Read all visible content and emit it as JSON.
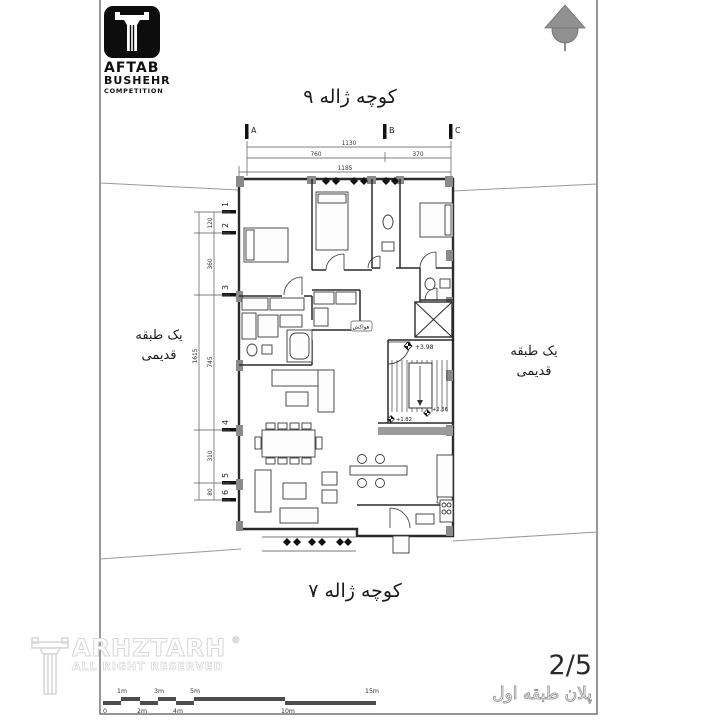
{
  "logo": {
    "title": "AFTAB",
    "subtitle": "BUSHEHR",
    "tagline": "COMPETITION"
  },
  "streets": {
    "top": "کوچه ژاله ۹",
    "bottom": "کوچه ژاله ۷"
  },
  "neighbors": {
    "left": [
      "یک طبقه",
      "قدیمی"
    ],
    "right": [
      "یک طبقه",
      "قدیمی"
    ]
  },
  "grid": {
    "cols": [
      "A",
      "B",
      "C"
    ],
    "rows": [
      "1",
      "2",
      "3",
      "4",
      "5",
      "6"
    ]
  },
  "dims": {
    "top_total": "1130",
    "top_left": "760",
    "top_right": "370",
    "top_outer": "1185",
    "left_total": "1615",
    "left_segs": [
      "120",
      "360",
      "745",
      "310",
      "80"
    ],
    "room": "525"
  },
  "levels": [
    "+3.98",
    "+2.36",
    "+1.82"
  ],
  "labels": {
    "duct": "هواکش"
  },
  "watermark": {
    "brand": "ARHZTARH",
    "reg": "®",
    "rights": "ALL RIGHT RESERVED"
  },
  "scalebar": {
    "above": [
      "1m",
      "3m",
      "5m",
      "15m"
    ],
    "below": [
      "0",
      "2m",
      "4m",
      "10m"
    ]
  },
  "titleblock": {
    "sheet_no": "2/5",
    "sheet_title": "پلان طبقه اول"
  },
  "colors": {
    "ink": "#2a2a2a",
    "wall_gray": "#8a8a8a",
    "scalebar": "#4d4d4d",
    "north": "#909090"
  }
}
